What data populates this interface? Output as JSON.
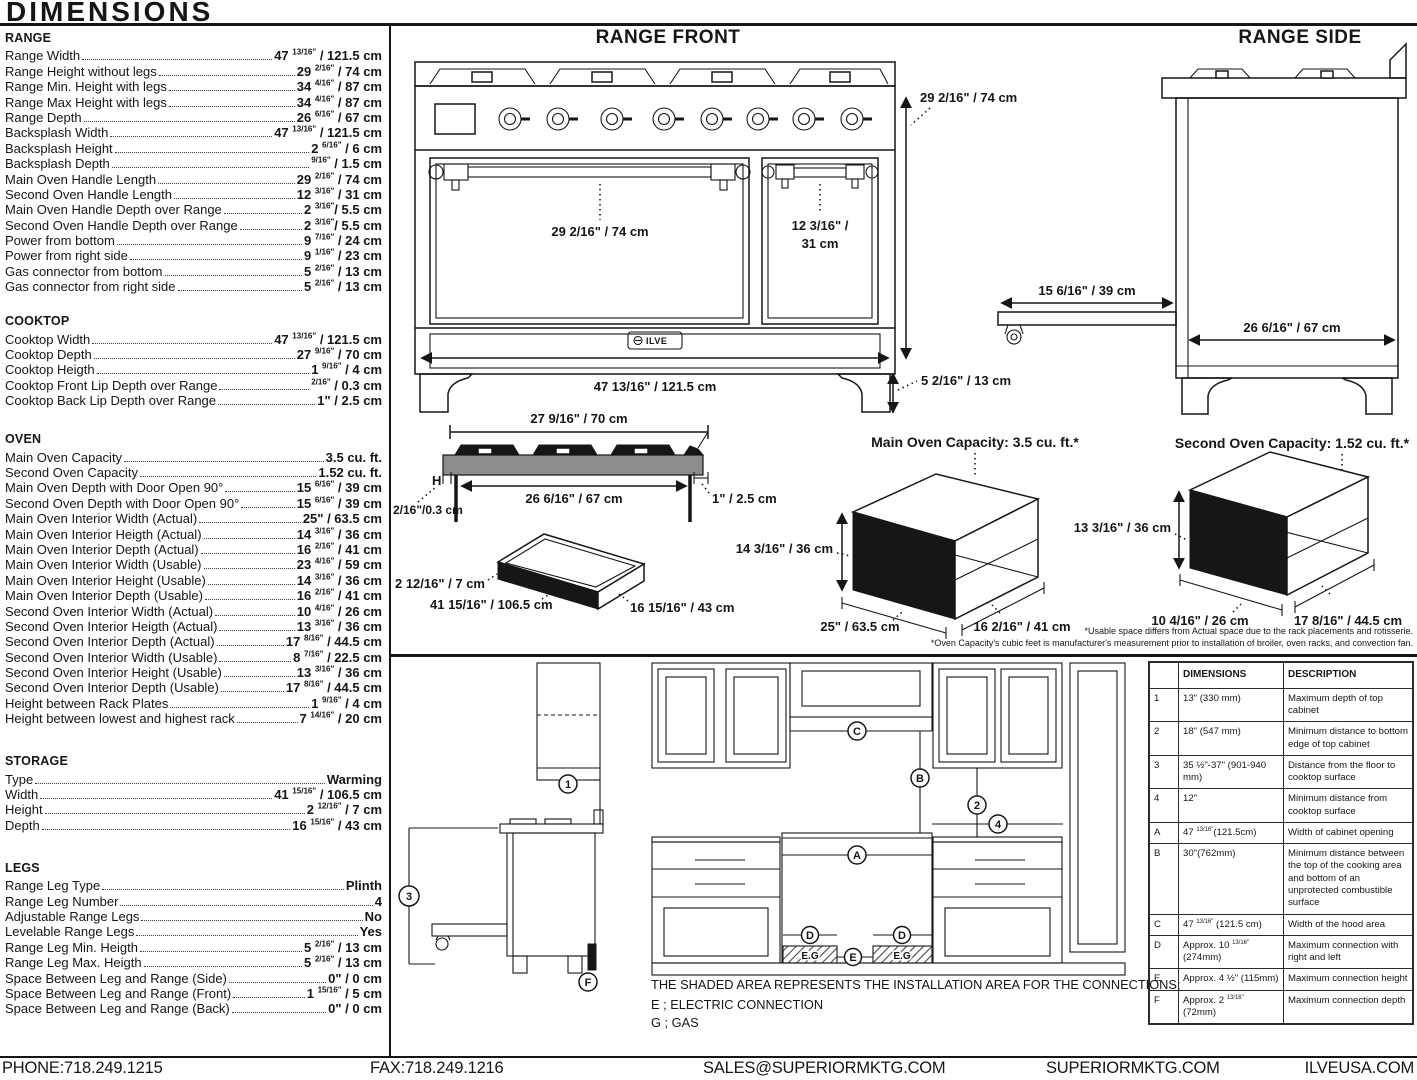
{
  "title": "DIMENSIONS",
  "specs": {
    "range": {
      "title": "RANGE",
      "rows": [
        {
          "label": "Range Width",
          "value": "47 13/16\" / 121.5 cm"
        },
        {
          "label": "Range Height without legs",
          "value": "29 2/16\" / 74 cm"
        },
        {
          "label": "Range Min. Height with legs",
          "value": "34 4/16\" / 87 cm"
        },
        {
          "label": "Range Max Height with legs",
          "value": "34 4/16\" / 87 cm"
        },
        {
          "label": "Range Depth",
          "value": "26 6/16\" / 67 cm"
        },
        {
          "label": "Backsplash Width",
          "value": "47 13/16\" / 121.5 cm"
        },
        {
          "label": "Backsplash Height",
          "value": "2 6/16\" / 6 cm"
        },
        {
          "label": "Backsplash Depth",
          "value": "9/16\" / 1.5 cm"
        },
        {
          "label": "Main Oven Handle Length",
          "value": "29 2/16\" / 74 cm"
        },
        {
          "label": "Second Oven Handle Length",
          "value": "12 3/16\" / 31 cm"
        },
        {
          "label": "Main Oven Handle Depth over Range",
          "value": "2 3/16\"/ 5.5 cm"
        },
        {
          "label": "Second Oven Handle Depth over Range",
          "value": "2 3/16\"/ 5.5 cm"
        },
        {
          "label": "Power from bottom",
          "value": "9 7/16\" / 24 cm"
        },
        {
          "label": "Power from right side",
          "value": "9 1/16\" / 23 cm"
        },
        {
          "label": "Gas connector from bottom",
          "value": "5 2/16\" / 13 cm"
        },
        {
          "label": "Gas connector from right side",
          "value": "5 2/16\" / 13 cm"
        }
      ]
    },
    "cooktop": {
      "title": "COOKTOP",
      "rows": [
        {
          "label": "Cooktop Width",
          "value": "47 13/16\" / 121.5 cm"
        },
        {
          "label": "Cooktop Depth",
          "value": "27 9/16\" / 70 cm"
        },
        {
          "label": "Cooktop Heigth",
          "value": "1 9/16\" / 4 cm"
        },
        {
          "label": "Cooktop Front Lip Depth over Range",
          "value": "2/16\" / 0.3 cm"
        },
        {
          "label": "Cooktop Back Lip Depth over Range",
          "value": "1\" / 2.5 cm"
        }
      ]
    },
    "oven": {
      "title": "OVEN",
      "rows": [
        {
          "label": "Main Oven Capacity",
          "value": "3.5 cu. ft."
        },
        {
          "label": "Second Oven Capacity",
          "value": "1.52 cu. ft."
        },
        {
          "label": "Main Oven Depth with Door Open 90°",
          "value": "15 6/16\" / 39 cm"
        },
        {
          "label": "Second Oven Depth with Door Open 90°",
          "value": "15 6/16\" / 39 cm"
        },
        {
          "label": "Main Oven Interior Width (Actual)",
          "value": "25\" / 63.5 cm"
        },
        {
          "label": "Main Oven Interior Heigth (Actual)",
          "value": "14 3/16\" / 36 cm"
        },
        {
          "label": "Main Oven Interior Depth (Actual)",
          "value": "16 2/16\" / 41 cm"
        },
        {
          "label": "Main Oven Interior Width (Usable)",
          "value": "23 4/16\" / 59 cm"
        },
        {
          "label": "Main Oven Interior Height (Usable)",
          "value": "14 3/16\" / 36 cm"
        },
        {
          "label": "Main Oven Interior Depth (Usable)",
          "value": "16 2/16\" / 41 cm"
        },
        {
          "label": "Second Oven Interior Width (Actual)",
          "value": "10 4/16\" / 26 cm"
        },
        {
          "label": "Second Oven Interior Heigth (Actual)",
          "value": "13 3/16\" / 36 cm"
        },
        {
          "label": "Second Oven Interior Depth (Actual)",
          "value": "17 8/16\" / 44.5 cm"
        },
        {
          "label": "Second Oven Interior Width (Usable)",
          "value": "8 7/16\" / 22.5 cm"
        },
        {
          "label": "Second Oven Interior Height (Usable)",
          "value": "13 3/16\" / 36 cm"
        },
        {
          "label": "Second Oven Interior Depth (Usable)",
          "value": "17 8/16\" / 44.5 cm"
        },
        {
          "label": "Height between Rack Plates",
          "value": "1 9/16\" / 4 cm"
        },
        {
          "label": "Height between lowest and highest rack",
          "value": "7 14/16\" / 20 cm"
        }
      ]
    },
    "storage": {
      "title": "STORAGE",
      "rows": [
        {
          "label": "Type",
          "value": "Warming"
        },
        {
          "label": "Width",
          "value": "41 15/16\" / 106.5 cm"
        },
        {
          "label": "Height",
          "value": "2 12/16\" / 7 cm"
        },
        {
          "label": "Depth",
          "value": "16 15/16\" / 43 cm"
        }
      ]
    },
    "legs": {
      "title": "LEGS",
      "rows": [
        {
          "label": "Range Leg Type",
          "value": "Plinth"
        },
        {
          "label": "Range Leg Number",
          "value": "4"
        },
        {
          "label": "Adjustable Range Legs",
          "value": "No"
        },
        {
          "label": "Levelable Range Legs",
          "value": "Yes"
        },
        {
          "label": "Range Leg Min. Heigth",
          "value": "5 2/16\" / 13 cm"
        },
        {
          "label": "Range Leg Max. Heigth",
          "value": "5 2/16\" / 13 cm"
        },
        {
          "label": "Space Between Leg and Range (Side)",
          "value": "0\" / 0 cm"
        },
        {
          "label": "Space Between Leg and Range (Front)",
          "value": "1 15/16\" / 5 cm"
        },
        {
          "label": "Space Between Leg and Range (Back)",
          "value": "0\" / 0 cm"
        }
      ]
    }
  },
  "diagrams": {
    "range_front": {
      "title": "RANGE FRONT",
      "height": "29 2/16\" / 74 cm",
      "width": "47 13/16\" / 121.5 cm",
      "leg_height": "5 2/16\" / 13 cm",
      "main_handle": "29 2/16\" / 74 cm",
      "second_handle_line1": "12 3/16\" /",
      "second_handle_line2": "31 cm",
      "brand": "ILVE"
    },
    "range_side": {
      "title": "RANGE SIDE",
      "door_open": "15 6/16\" / 39 cm",
      "depth": "26 6/16\" / 67 cm"
    },
    "cooktop_profile": {
      "width_top": "27 9/16\" / 70 cm",
      "width_inner": "26 6/16\" / 67 cm",
      "back_lip": "1\" / 2.5 cm",
      "front_lip": "2/16\"/0.3 cm",
      "h_label": "H"
    },
    "storage_drawer": {
      "height": "2 12/16\" / 7 cm",
      "width": "41 15/16\" / 106.5 cm",
      "depth": "16 15/16\" / 43 cm"
    },
    "main_oven": {
      "title": "Main Oven Capacity: 3.5 cu. ft.*",
      "height": "14 3/16\" / 36 cm",
      "width": "25\" / 63.5 cm",
      "depth": "16 2/16\" / 41 cm"
    },
    "second_oven": {
      "title": "Second Oven Capacity: 1.52 cu. ft.*",
      "height": "13 3/16\" / 36 cm",
      "width": "10 4/16\" / 26 cm",
      "depth": "17 8/16\" / 44.5 cm"
    },
    "footnote1": "*Usable space differs from Actual space due to the rack placements and rotisserie.",
    "footnote2": "*Oven Capacity's cubic feet is manufacturer's measurement prior to installation of broiler, oven racks, and convection fan."
  },
  "installation": {
    "markers": {
      "m1": "1",
      "m2": "2",
      "m3": "3",
      "m4": "4",
      "a": "A",
      "b": "B",
      "c": "C",
      "d": "D",
      "e": "E",
      "f": "F"
    },
    "eg_label": "E.G",
    "note": "THE SHADED AREA REPRESENTS THE INSTALLATION AREA FOR THE CONNECTIONS;",
    "electric": "E ; ELECTRIC CONNECTION",
    "gas": "G ; GAS",
    "table": {
      "headers": [
        "DIMENSIONS",
        "DESCRIPTION"
      ],
      "rows": [
        {
          "key": "1",
          "dim": "13\" (330 mm)",
          "desc": "Maximum depth of top cabinet"
        },
        {
          "key": "2",
          "dim": "18\" (547 mm)",
          "desc": "Minimum distance to bottom edge of top cabinet"
        },
        {
          "key": "3",
          "dim": "35 ½\"-37\" (901-940 mm)",
          "desc": "Distance from the floor to cooktop surface"
        },
        {
          "key": "4",
          "dim": "12\"",
          "desc": "Minimum distance from cooktop surface"
        },
        {
          "key": "A",
          "dim": "47 13/16\"(121.5cm)",
          "desc": "Width of cabinet opening"
        },
        {
          "key": "B",
          "dim": "30\"(762mm)",
          "desc": "Minimum distance between the top of the cooking area and bottom of an unprotected combustible surface"
        },
        {
          "key": "C",
          "dim": "47 13/16\" (121.5 cm)",
          "desc": "Width of the hood area"
        },
        {
          "key": "D",
          "dim": "Approx. 10 13/16\" (274mm)",
          "desc": "Maximum connection with right and left"
        },
        {
          "key": "E",
          "dim": "Approx. 4 ½\" (115mm)",
          "desc": "Maximum connection height"
        },
        {
          "key": "F",
          "dim": "Approx. 2 13/16\" (72mm)",
          "desc": "Maximum connection depth"
        }
      ]
    }
  },
  "footer": {
    "phone": "PHONE:718.249.1215",
    "fax": "FAX:718.249.1216",
    "email": "SALES@SUPERIORMKTG.COM",
    "site": "SUPERIORMKTG.COM",
    "brand_site": "ILVEUSA.COM"
  }
}
